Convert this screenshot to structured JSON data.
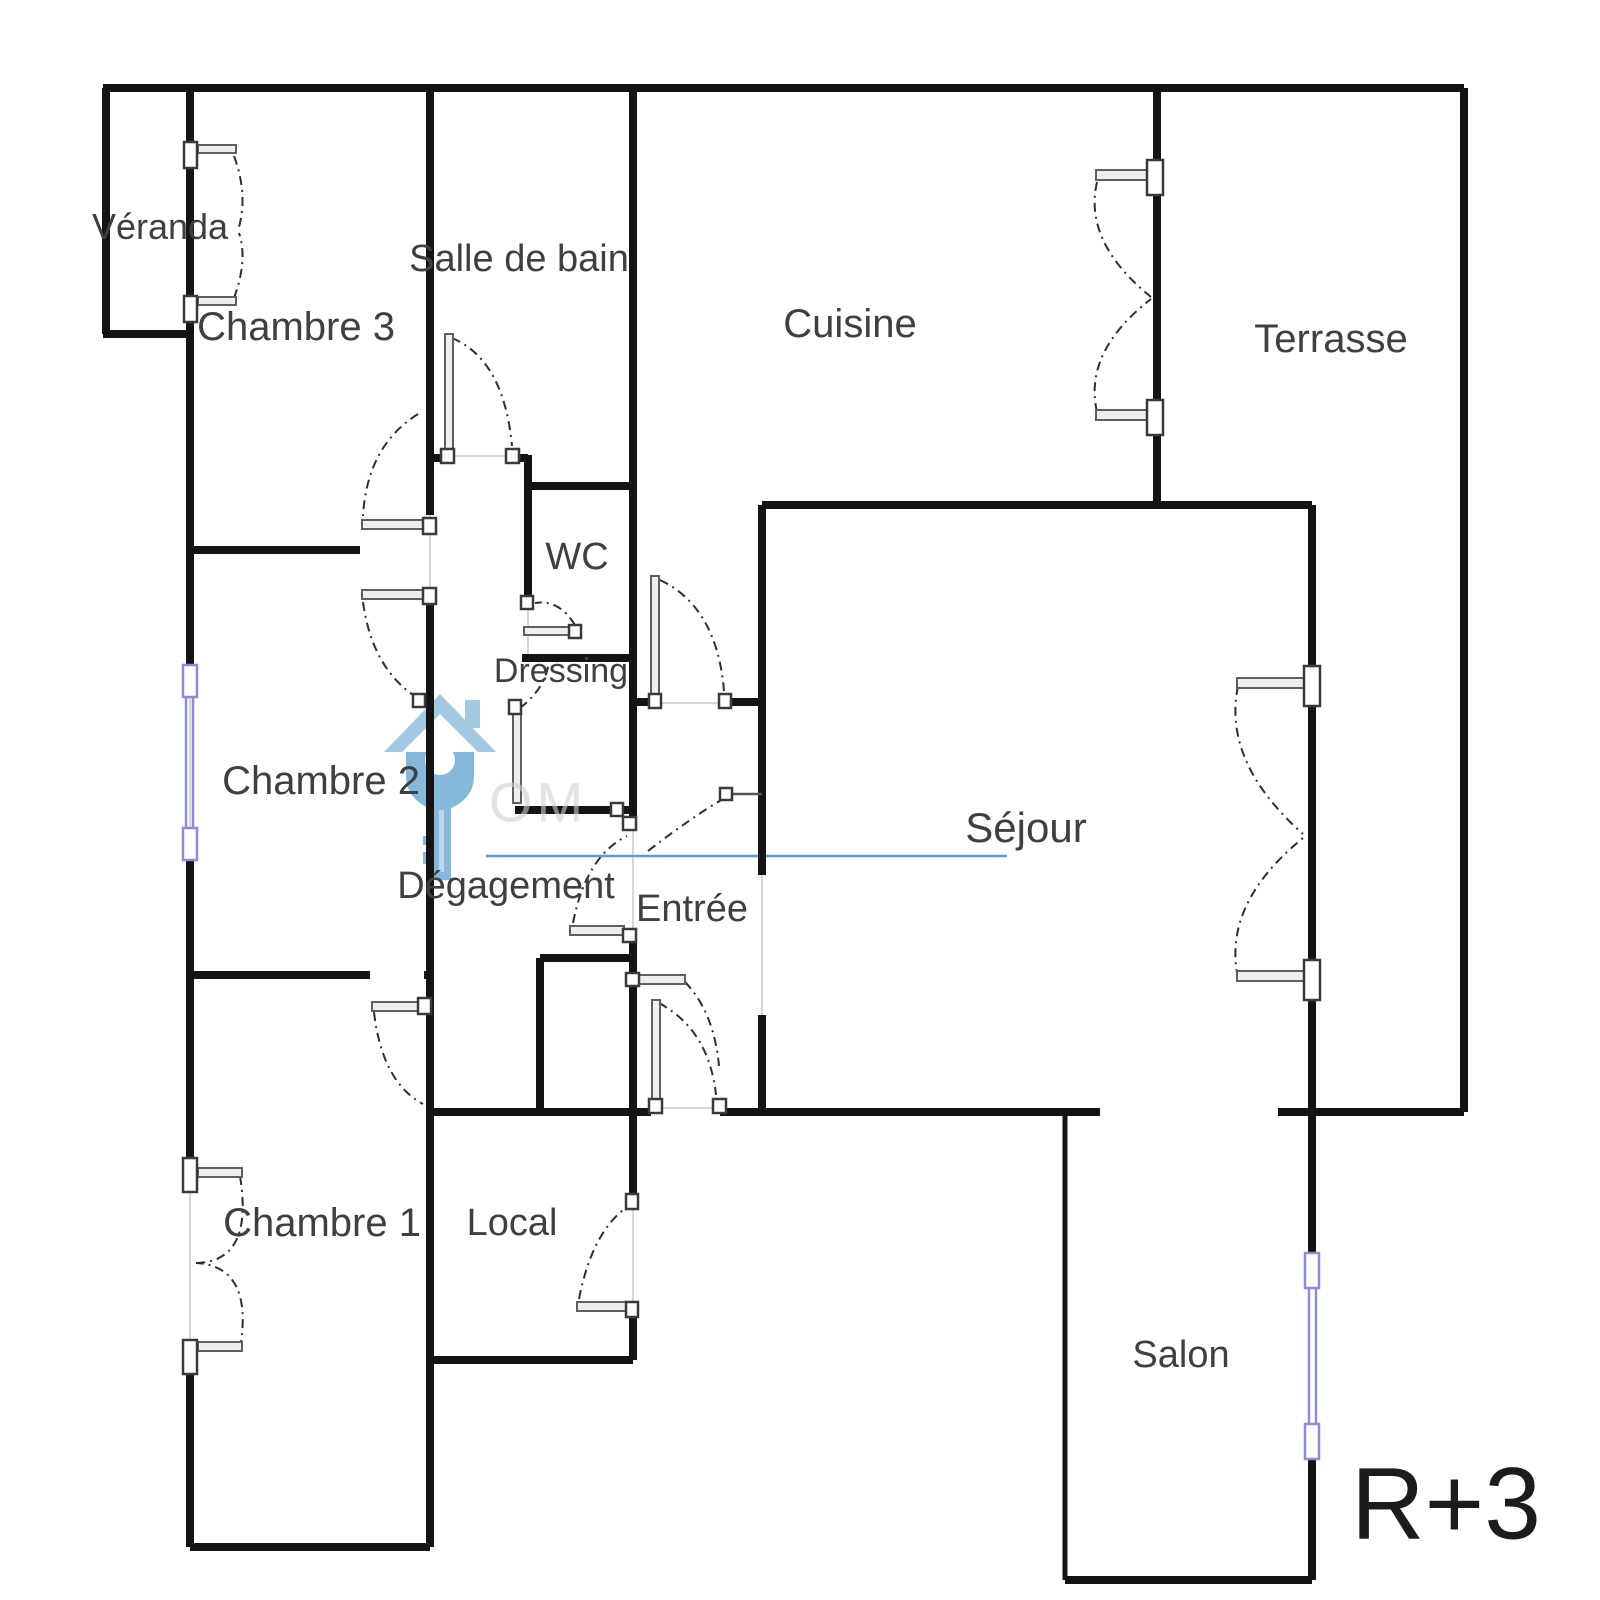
{
  "title": "Plan d'appartement R+3",
  "floor_label": "R+3",
  "rooms": [
    {
      "name": "Véranda",
      "x": 160,
      "y": 227,
      "size": 36
    },
    {
      "name": "Chambre 3",
      "x": 296,
      "y": 327,
      "size": 40
    },
    {
      "name": "Salle de bain",
      "x": 519,
      "y": 259,
      "size": 38
    },
    {
      "name": "Cuisine",
      "x": 850,
      "y": 324,
      "size": 40
    },
    {
      "name": "Terrasse",
      "x": 1331,
      "y": 339,
      "size": 40
    },
    {
      "name": "WC",
      "x": 577,
      "y": 557,
      "size": 38
    },
    {
      "name": "Dressing",
      "x": 561,
      "y": 671,
      "size": 34
    },
    {
      "name": "Chambre 2",
      "x": 321,
      "y": 781,
      "size": 40
    },
    {
      "name": "Séjour",
      "x": 1026,
      "y": 828,
      "size": 42
    },
    {
      "name": "Dégagement",
      "x": 506,
      "y": 886,
      "size": 38
    },
    {
      "name": "Entrée",
      "x": 692,
      "y": 909,
      "size": 38
    },
    {
      "name": "Chambre 1",
      "x": 322,
      "y": 1223,
      "size": 40
    },
    {
      "name": "Local",
      "x": 512,
      "y": 1223,
      "size": 38
    },
    {
      "name": "Salon",
      "x": 1181,
      "y": 1355,
      "size": 38
    }
  ],
  "watermark": {
    "icon": "house-key-icon",
    "ghost_text": "OM",
    "underline_color": "#5b9bd5",
    "icon_color_main": "#7cb2d9",
    "icon_color_light": "#9cc4e2",
    "icon_color_stripe": "#b7d5ec"
  },
  "colors": {
    "wall": "#141414",
    "label": "#3f3f3f",
    "door_arc": "#2e2e2e",
    "leaf_fill": "#efefef",
    "leaf_stroke": "#5f5f5f",
    "window_accent": "#8c8cd0",
    "guide": "#c9c9c9"
  }
}
